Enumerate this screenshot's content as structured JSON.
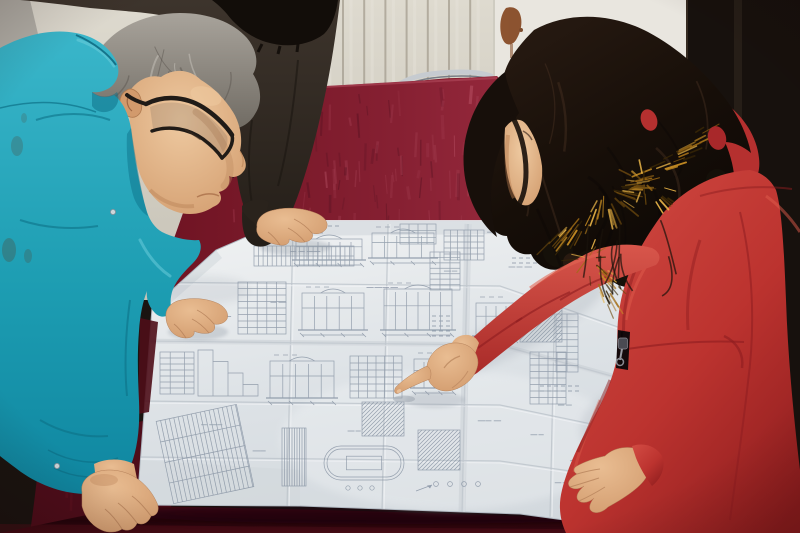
{
  "scene": {
    "description": "Three people lean over a large folded engineering blueprint spread on a dark red velvet covered table: a gray-haired man in a teal work jacket and black glasses studies the sheet with both hands on it, a colleague in a dark coat rests a hand on the top edge, and a woman in a red down parka with an orange fur-trimmed hood points at a detail with her index finger",
    "setting": {
      "left_wall": "white panel radiator with vertical fins",
      "radiator_color": "#d7d3c7",
      "door_color": "#e9e6df",
      "right_wall_color": "#17110d",
      "table_cloth": "dark red velvet",
      "velvet_base": "#7c1a2c",
      "velvet_front": "#2e060d",
      "chair": "chrome framed chair behind table"
    },
    "people": [
      {
        "id": "engineer",
        "position": "left",
        "hair": "gray",
        "glasses": "black rectangular",
        "clothing": "teal work jacket with snap cuffs",
        "pose": "leaning over drawing, right hand on sheet, left hand on table corner"
      },
      {
        "id": "colleague",
        "position": "behind engineer, top",
        "hair": "black",
        "clothing": "dark brown coat",
        "pose": "hand resting on top edge of drawing"
      },
      {
        "id": "woman",
        "position": "right",
        "hair": "long dark brown waves",
        "clothing": "red down parka with orange fur hood trim and front zipper",
        "pose": "pointing at blueprint with right index finger, left hand flat on sheet"
      }
    ],
    "radiator": {
      "fin_start": 237,
      "fin_end": 491,
      "fin_step": 21.2
    },
    "velvet_streaks": {
      "count": 130,
      "corner_count": 18,
      "seed": 11
    },
    "blueprint": {
      "sheet_color": "#dde2e6",
      "line_color": "#8793a3",
      "crease_x": [
        293,
        388,
        468,
        556,
        646,
        734
      ],
      "crease_y": [
        282,
        341,
        401,
        457
      ],
      "scatter_clusters": 16,
      "blocks": [
        {
          "t": "band",
          "x": 254,
          "y": 246,
          "w": 100,
          "h": 20,
          "cols": 22
        },
        {
          "t": "elevation",
          "x": 296,
          "y": 236,
          "w": 66,
          "h": 24
        },
        {
          "t": "elevation",
          "x": 372,
          "y": 230,
          "w": 62,
          "h": 28
        },
        {
          "t": "grid",
          "x": 444,
          "y": 230,
          "w": 40,
          "h": 30,
          "rows": 5,
          "cols": 6
        },
        {
          "t": "grid",
          "x": 400,
          "y": 224,
          "w": 36,
          "h": 20,
          "rows": 3,
          "cols": 4
        },
        {
          "t": "ticks",
          "x": 300,
          "y": 226,
          "rows": 1,
          "cols": 6
        },
        {
          "t": "grid",
          "x": 238,
          "y": 282,
          "w": 48,
          "h": 52,
          "rows": 8,
          "cols": 5
        },
        {
          "t": "elevation",
          "x": 302,
          "y": 290,
          "w": 62,
          "h": 40
        },
        {
          "t": "elevation",
          "x": 384,
          "y": 286,
          "w": 68,
          "h": 44
        },
        {
          "t": "grid",
          "x": 430,
          "y": 252,
          "w": 30,
          "h": 38,
          "rows": 7,
          "cols": 3
        },
        {
          "t": "ticks",
          "x": 432,
          "y": 316,
          "rows": 5,
          "cols": 3
        },
        {
          "t": "stair",
          "x": 198,
          "y": 350,
          "w": 60,
          "h": 46
        },
        {
          "t": "elevation",
          "x": 270,
          "y": 358,
          "w": 64,
          "h": 40
        },
        {
          "t": "grid",
          "x": 350,
          "y": 356,
          "w": 52,
          "h": 42,
          "rows": 6,
          "cols": 6
        },
        {
          "t": "hatch",
          "x": 362,
          "y": 402,
          "w": 42,
          "h": 34
        },
        {
          "t": "elevation",
          "x": 414,
          "y": 356,
          "w": 40,
          "h": 32
        },
        {
          "t": "table",
          "x": 160,
          "y": 352,
          "w": 34,
          "h": 42,
          "rows": 7
        },
        {
          "t": "tableRot",
          "x": 164,
          "y": 412,
          "w": 82,
          "h": 84,
          "rot": -12
        },
        {
          "t": "hatchV",
          "x": 282,
          "y": 428,
          "w": 24,
          "h": 58
        },
        {
          "t": "capsule",
          "x": 324,
          "y": 446,
          "w": 80,
          "h": 34
        },
        {
          "t": "hatch",
          "x": 418,
          "y": 430,
          "w": 42,
          "h": 40
        },
        {
          "t": "circles",
          "x": 430,
          "y": 474,
          "w": 54,
          "h": 20,
          "n": 4
        },
        {
          "t": "hatch",
          "x": 520,
          "y": 304,
          "w": 42,
          "h": 38
        },
        {
          "t": "grid",
          "x": 530,
          "y": 352,
          "w": 36,
          "h": 52,
          "rows": 8,
          "cols": 4
        },
        {
          "t": "grid",
          "x": 556,
          "y": 314,
          "w": 22,
          "h": 58,
          "rows": 9,
          "cols": 2
        },
        {
          "t": "elevation",
          "x": 476,
          "y": 300,
          "w": 40,
          "h": 36
        },
        {
          "t": "circles",
          "x": 584,
          "y": 434,
          "w": 42,
          "h": 40,
          "n": 5
        },
        {
          "t": "table",
          "x": 598,
          "y": 408,
          "w": 34,
          "h": 82,
          "rows": 12
        },
        {
          "t": "table",
          "x": 744,
          "y": 300,
          "w": 44,
          "h": 56,
          "rows": 8
        },
        {
          "t": "ticks",
          "x": 512,
          "y": 258,
          "rows": 2,
          "cols": 7
        },
        {
          "t": "ticks",
          "x": 540,
          "y": 386,
          "rows": 2,
          "cols": 6
        }
      ]
    },
    "fur_zones": [
      {
        "x1": 552,
        "y1": 242,
        "x2": 704,
        "y2": 136,
        "cx": 604,
        "cy": 188,
        "n": 70,
        "len": 15
      },
      {
        "x1": 584,
        "y1": 250,
        "x2": 614,
        "y2": 298,
        "cx": 588,
        "cy": 258,
        "n": 28,
        "len": 11
      },
      {
        "x1": 634,
        "y1": 176,
        "x2": 666,
        "y2": 198,
        "cx": 644,
        "cy": 182,
        "n": 18,
        "len": 9
      }
    ],
    "fur_colors": [
      "#3a2806",
      "#6e4a0e",
      "#a06c16",
      "#c98f24",
      "#e8b448"
    ],
    "skin_color": "#dca87c",
    "accent_colors": {
      "teal_jacket": "#1e9fb4",
      "red_coat": "#c23a34",
      "fur_trim": "#b5771c",
      "velvet": "#7c1a2c"
    }
  }
}
